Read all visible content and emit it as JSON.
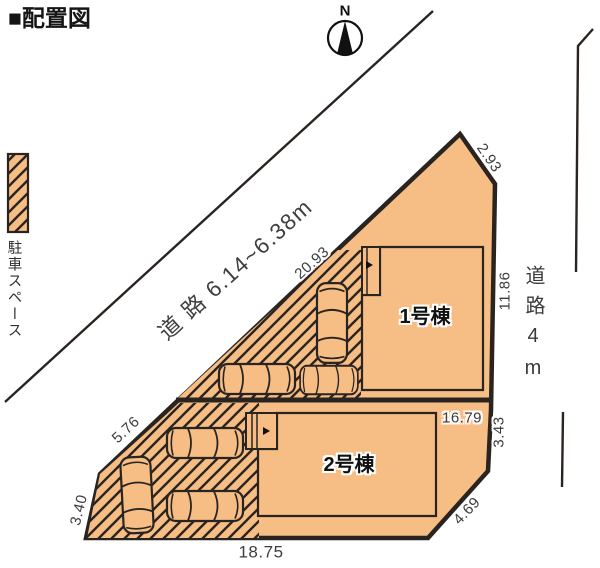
{
  "title": "■配置図",
  "compass": {
    "north_label": "N"
  },
  "legend": {
    "parking_label": "駐車スペース"
  },
  "roads": {
    "southwest_road": "道 路 6.14~6.38m",
    "east_road": "道路4m"
  },
  "buildings": {
    "building1": "1号棟",
    "building2": "2号棟"
  },
  "dimensions": {
    "northeast_top": "2.93",
    "diagonal_upper": "20.93",
    "east_upper": "11.86",
    "lot_divider": "16.79",
    "east_lower": "3.43",
    "southeast": "4.69",
    "south": "18.75",
    "diagonal_lower": "5.76",
    "southwest": "3.40"
  },
  "colors": {
    "lot_fill": "#F6BD84",
    "line": "#2A2421",
    "dim_text": "#3D3D3D"
  }
}
